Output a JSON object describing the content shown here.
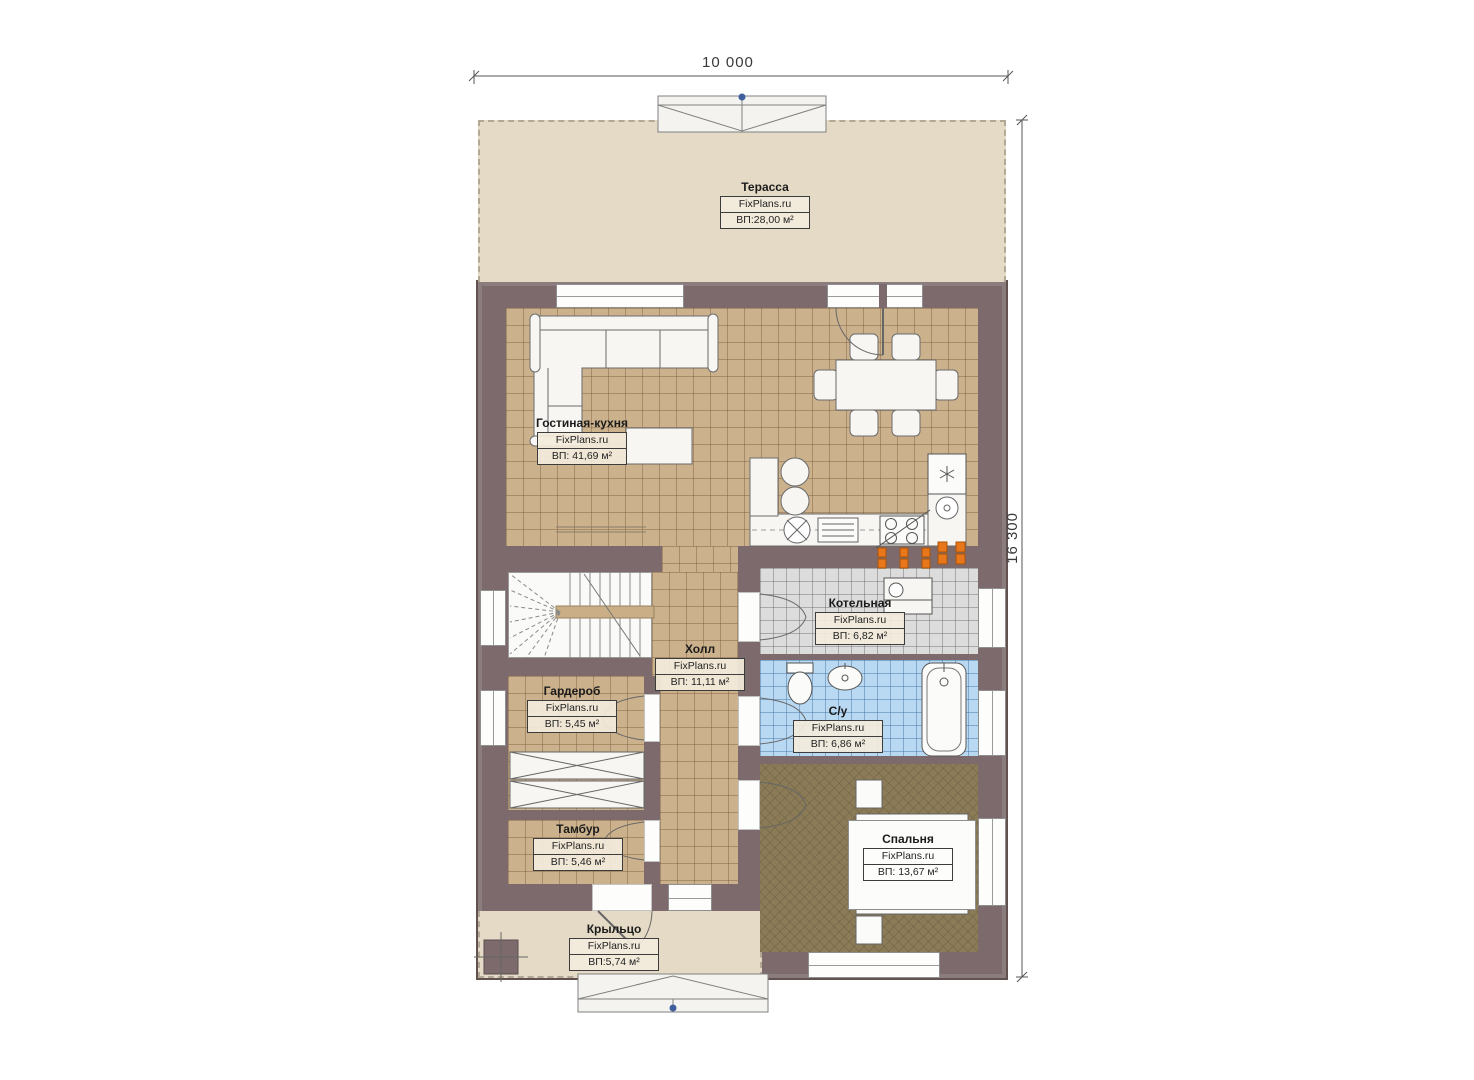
{
  "plan": {
    "dimensions": {
      "width_label": "10 000",
      "height_label": "16 300"
    },
    "brand": "FixPlans.ru",
    "rooms": [
      {
        "key": "terrace",
        "name": "Терасса",
        "brand": "FixPlans.ru",
        "area": "ВП:28,00 м²"
      },
      {
        "key": "living_kitchen",
        "name": "Гостиная-кухня",
        "brand": "FixPlans.ru",
        "area": "ВП: 41,69 м²"
      },
      {
        "key": "boiler",
        "name": "Котельная",
        "brand": "FixPlans.ru",
        "area": "ВП: 6,82 м²"
      },
      {
        "key": "hall",
        "name": "Холл",
        "brand": "FixPlans.ru",
        "area": "ВП: 11,11 м²"
      },
      {
        "key": "wardrobe",
        "name": "Гардероб",
        "brand": "FixPlans.ru",
        "area": "ВП: 5,45 м²"
      },
      {
        "key": "bathroom",
        "name": "С/у",
        "brand": "FixPlans.ru",
        "area": "ВП: 6,86 м²"
      },
      {
        "key": "vestibule",
        "name": "Тамбур",
        "brand": "FixPlans.ru",
        "area": "ВП: 5,46 м²"
      },
      {
        "key": "bedroom",
        "name": "Спальня",
        "brand": "FixPlans.ru",
        "area": "ВП: 13,67 м²"
      },
      {
        "key": "porch",
        "name": "Крыльцо",
        "brand": "FixPlans.ru",
        "area": "ВП:5,74 м²"
      }
    ],
    "colors": {
      "wall": "#7c6a6c",
      "floor_tile": "#cbb18c",
      "boiler_tile": "#dcdcdc",
      "bath_tile": "#b9d8f1",
      "bedroom_floor": "#8b7b57",
      "terrace": "#e4dac5",
      "radiator": "#e8761b",
      "marker_blue": "#3e5e9e"
    }
  }
}
